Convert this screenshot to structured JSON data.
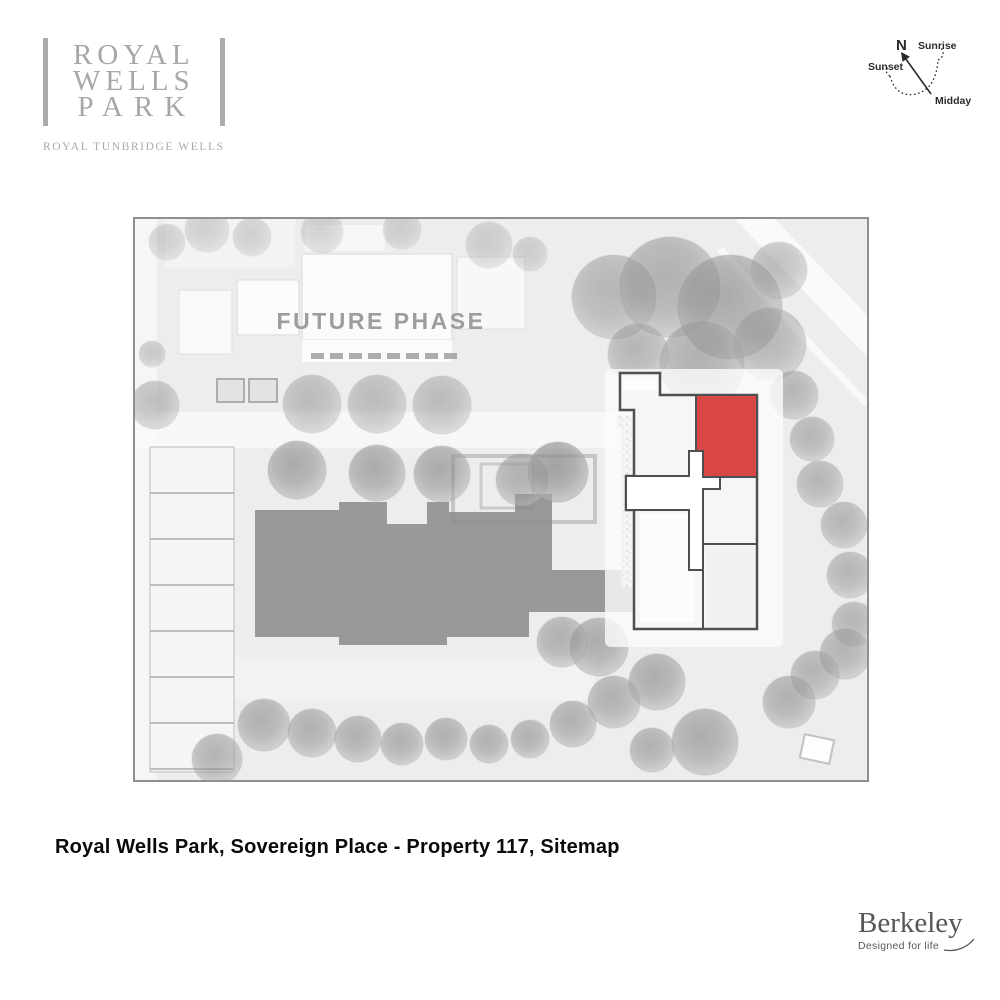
{
  "branding": {
    "logo_line1": "ROYAL",
    "logo_line2": "WELLS",
    "logo_line3": "PARK",
    "logo_subtitle": "ROYAL TUNBRIDGE WELLS"
  },
  "compass": {
    "north_label": "N",
    "sunrise_label": "Sunrise",
    "sunset_label": "Sunset",
    "midday_label": "Midday"
  },
  "sitemap": {
    "future_phase_label": "FUTURE PHASE",
    "colors": {
      "highlight": "#d84646",
      "building_outline": "#4f4f4f",
      "building_mass": "#999999",
      "map_background": "#ededed",
      "map_border": "#8f8f8f"
    }
  },
  "caption": {
    "text": "Royal Wells Park, Sovereign Place - Property 117, Sitemap"
  },
  "footer": {
    "brand": "Berkeley",
    "tagline": "Designed for life"
  }
}
